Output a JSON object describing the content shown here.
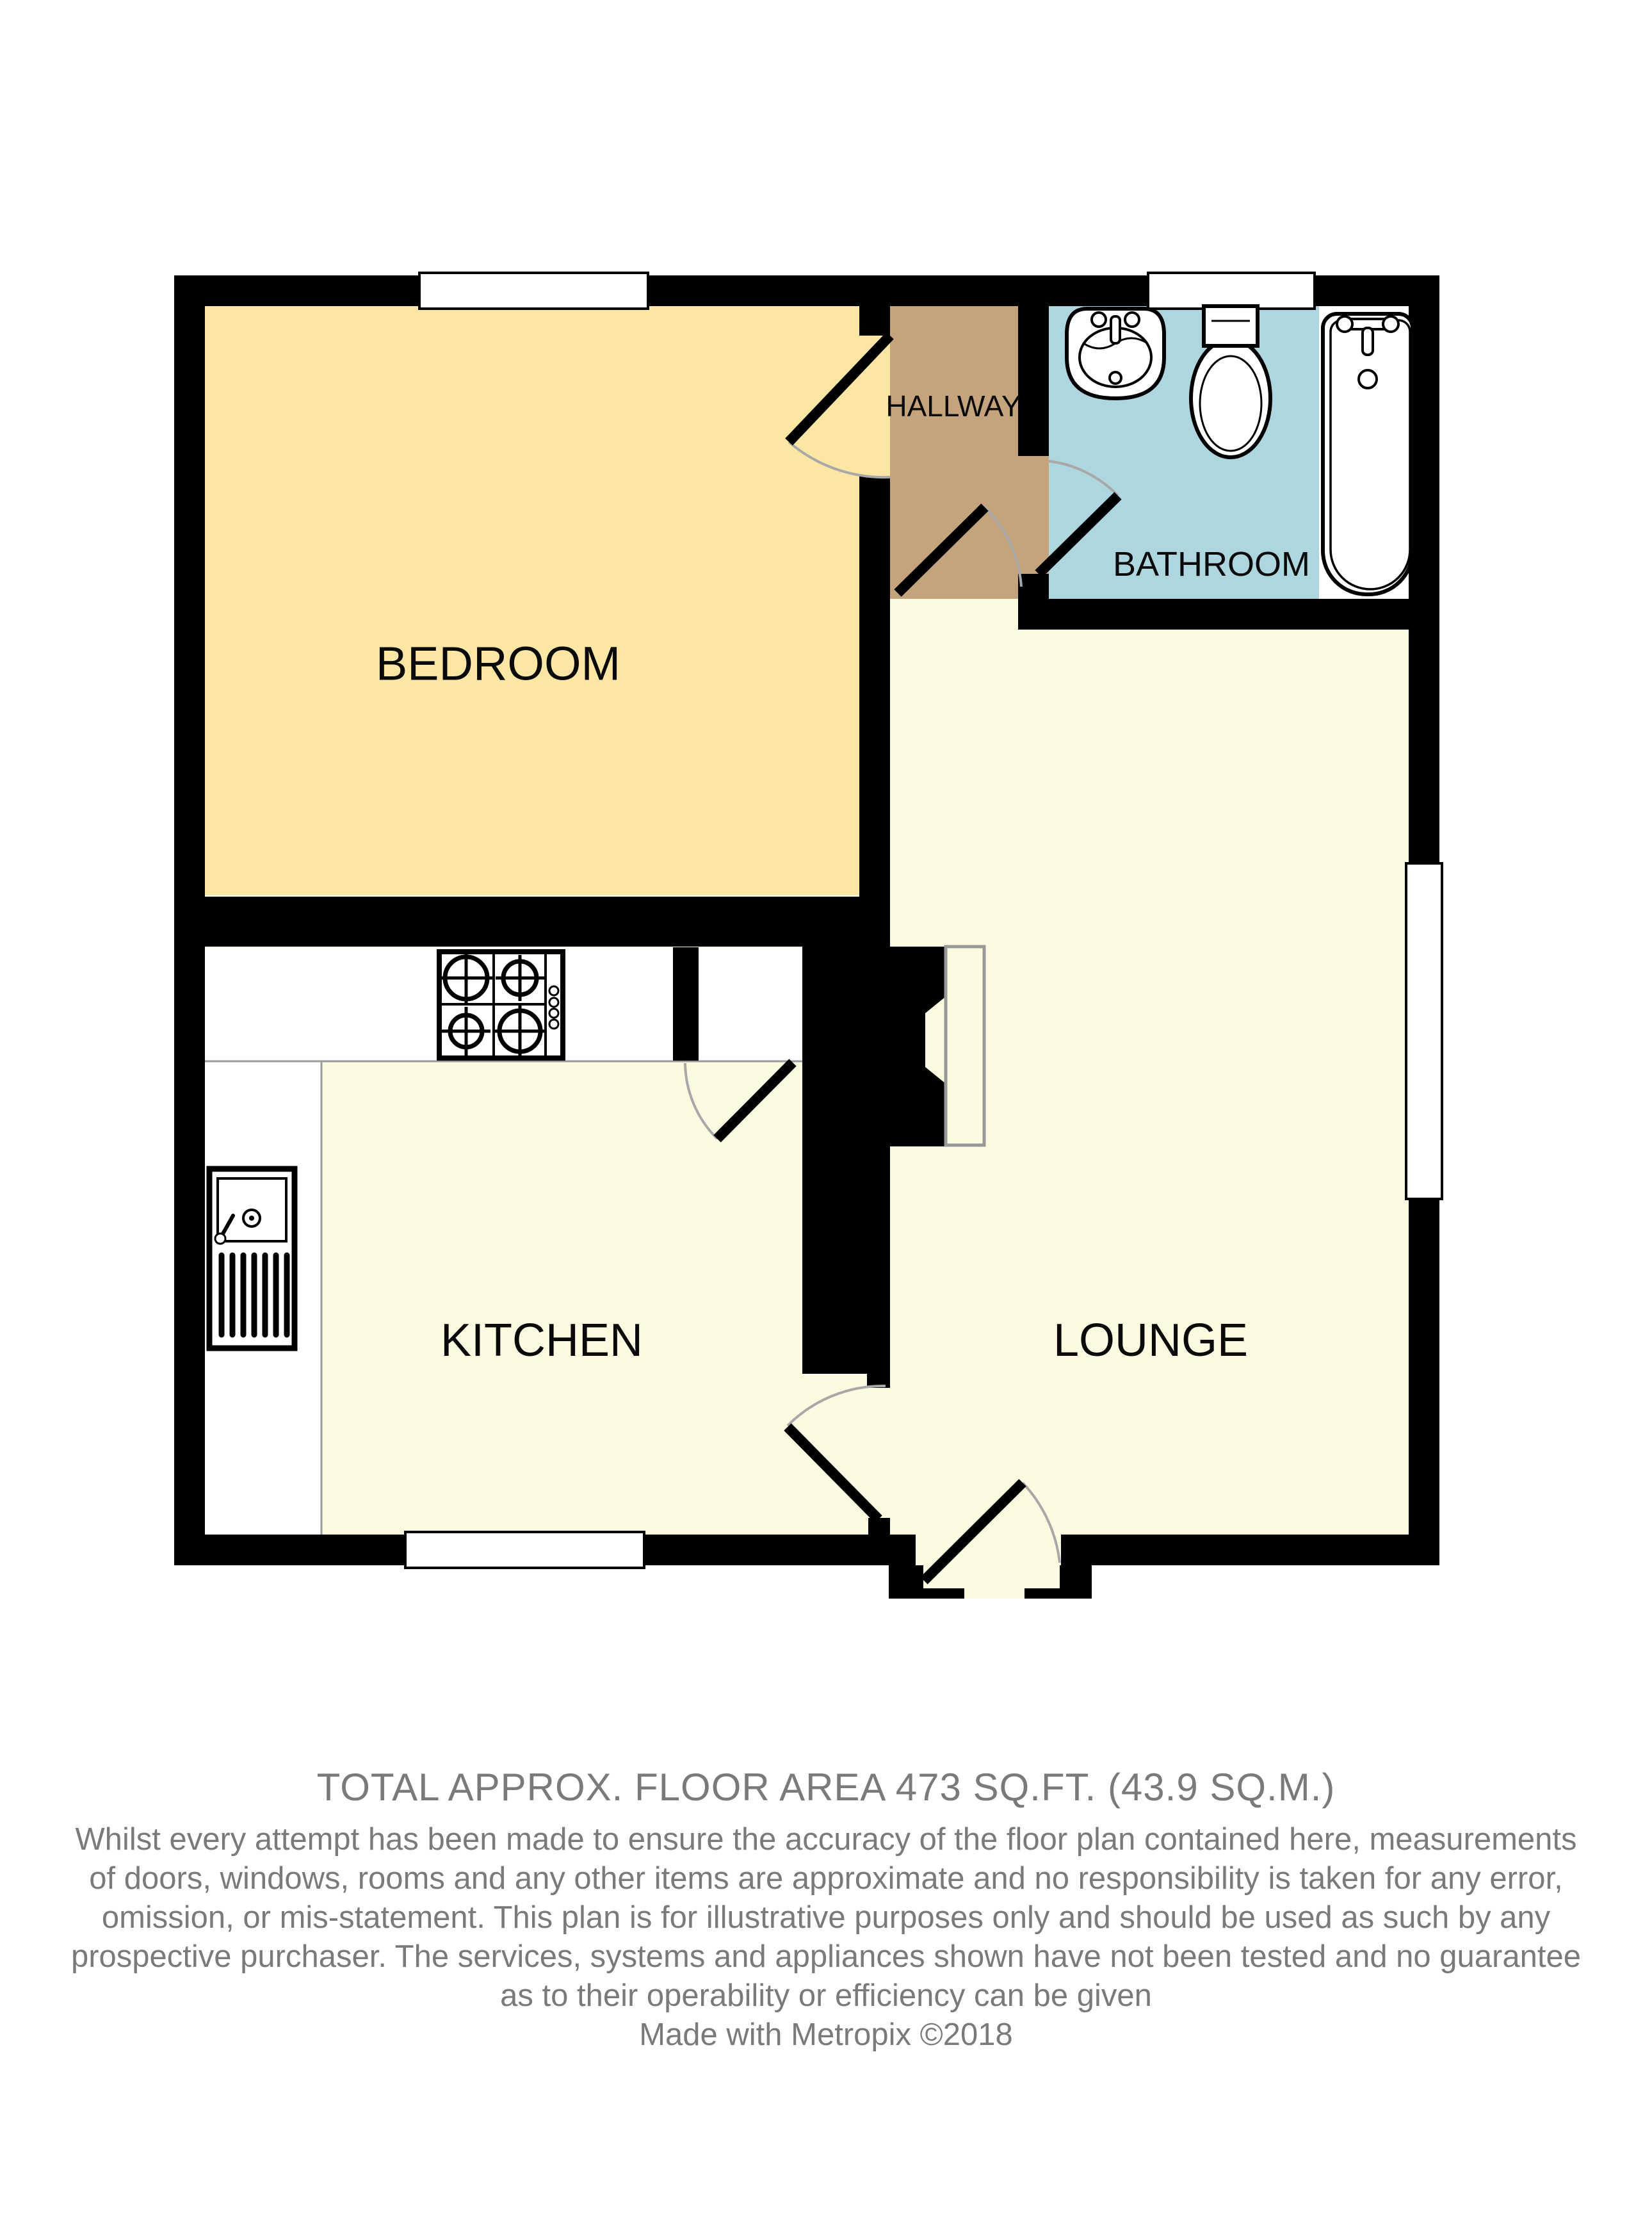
{
  "colors": {
    "wall": "#000000",
    "bedroom_fill": "#FBE6A3",
    "hallway_fill": "#C5A37C",
    "bathroom_fill": "#AED6DE",
    "cream_fill": "#FDFAE2",
    "counter_fill": "#FFFFFF",
    "window_fill": "#FFFFFF",
    "fixture_fill": "#FFFFFF",
    "door_arc": "#A8A8A8",
    "hearth_border": "#989898",
    "label_text": "#0A0A0A",
    "footer_text": "#7A7A7A"
  },
  "rooms": {
    "bedroom": {
      "label": "BEDROOM"
    },
    "hallway": {
      "label": "HALLWAY"
    },
    "bathroom": {
      "label": "BATHROOM"
    },
    "kitchen": {
      "label": "KITCHEN"
    },
    "lounge": {
      "label": "LOUNGE"
    }
  },
  "fixtures": {
    "bathroom": [
      "pedestal-sink",
      "toilet",
      "bathtub"
    ],
    "kitchen": [
      "four-burner-hob",
      "sink-with-drainer",
      "worktop-counter"
    ],
    "lounge": [
      "chimney-breast-with-hearth"
    ]
  },
  "footer": {
    "area_line": "TOTAL APPROX. FLOOR AREA 473 SQ.FT. (43.9 SQ.M.)",
    "disclaimer_lines": [
      "Whilst every attempt has been made to ensure the accuracy of the floor plan contained here, measurements",
      "of doors, windows, rooms and any other items are approximate and no responsibility is taken for any error,",
      "omission, or mis-statement. This plan is for illustrative purposes only and should be used as such by any",
      "prospective purchaser. The services, systems and appliances shown have not been tested and no guarantee",
      "as to their operability or efficiency can be given",
      "Made with Metropix ©2018"
    ]
  }
}
